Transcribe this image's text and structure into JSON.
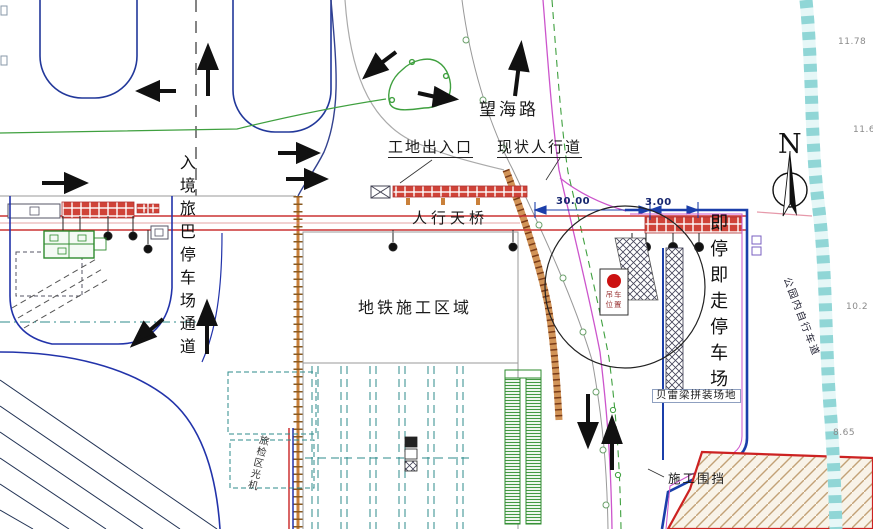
{
  "labels": {
    "wanghai_road": "望海路",
    "site_entrance": "工地出入口",
    "existing_sidewalk": "现状人行道",
    "pedestrian_bridge": "人行天桥",
    "metro_construction_area": "地铁施工区域",
    "inbound_bus_channel": "入境旅巴停车场通道",
    "drop_off_parking": "即停即走停车场",
    "bailey_beam_yard": "贝雷梁拼装场地",
    "construction_enclosure": "施工围挡",
    "crane_position_line1": "吊车",
    "crane_position_line2": "位置",
    "north_mark": "N",
    "park_bike_path": "公园内自行车道",
    "xray_machine_area": "旅检区光机"
  },
  "dimensions": {
    "bridge_width": "30.00",
    "edge_offset": "3.00"
  },
  "elevations": {
    "e1": "11.78",
    "e2": "11.6",
    "e3": "10.2",
    "e4": "8.65"
  },
  "colors": {
    "bridge_red": "#cc3333",
    "boundary_blue": "#1b3faa",
    "road_magenta": "#cc55cc",
    "survey_green": "#3fa03f",
    "fence_orange": "#c9803a",
    "bike_path_cyan": "#90d6d6",
    "crane_red": "#cc1111",
    "stall_red": "#cf4338"
  }
}
